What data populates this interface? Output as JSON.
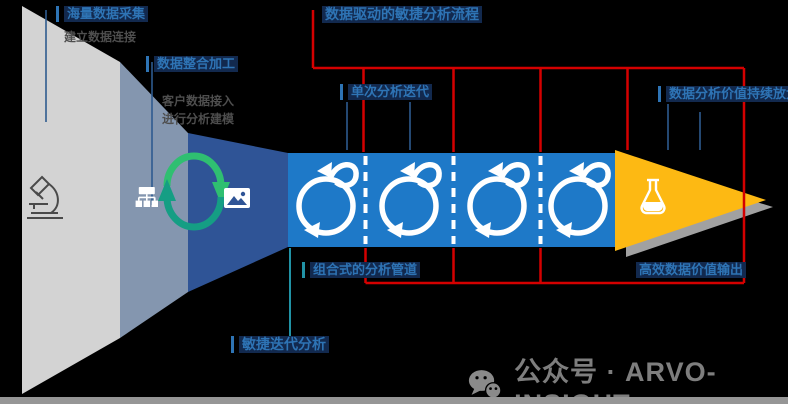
{
  "labels": {
    "stage1": {
      "title": "海量数据采集",
      "note": "建立数据连接"
    },
    "stage2": {
      "title": "数据整合加工",
      "note1": "客户数据接入",
      "note2": "进行分析建模"
    },
    "top": {
      "title": "数据驱动的敏捷分析流程"
    },
    "iteration": {
      "title": "单次分析迭代"
    },
    "right": {
      "title": "数据分析价值持续放大"
    },
    "bottom_left": {
      "title": "敏捷迭代分析"
    },
    "bottom_mid": {
      "title": "组合式的分析管道"
    },
    "bottom_right": {
      "title": "高效数据价值输出"
    }
  },
  "watermark": {
    "text": "公众号 · ARVO-INSIGHT"
  },
  "icons": {
    "stage1": "microscope-icon",
    "stage2": "org-chart-icon",
    "cycle": "green-sync-arrows-icon",
    "stage3": "image-icon",
    "band": "iteration-loop-icon",
    "output": "flask-icon",
    "watermark": "wechat-icon"
  },
  "colors": {
    "stage1_gray": "#d3d3d3",
    "stage2_slate": "#8496af",
    "stage3_navy": "#2f5496",
    "band_blue": "#1e79c8",
    "arrow_gold": "#fdb913",
    "bracket_red": "#d40000",
    "label_blue": "#2e74b5",
    "cycle_green": "#2fbf71",
    "cycle_teal": "#159e84",
    "watermark_gray": "#7e7e7e"
  }
}
